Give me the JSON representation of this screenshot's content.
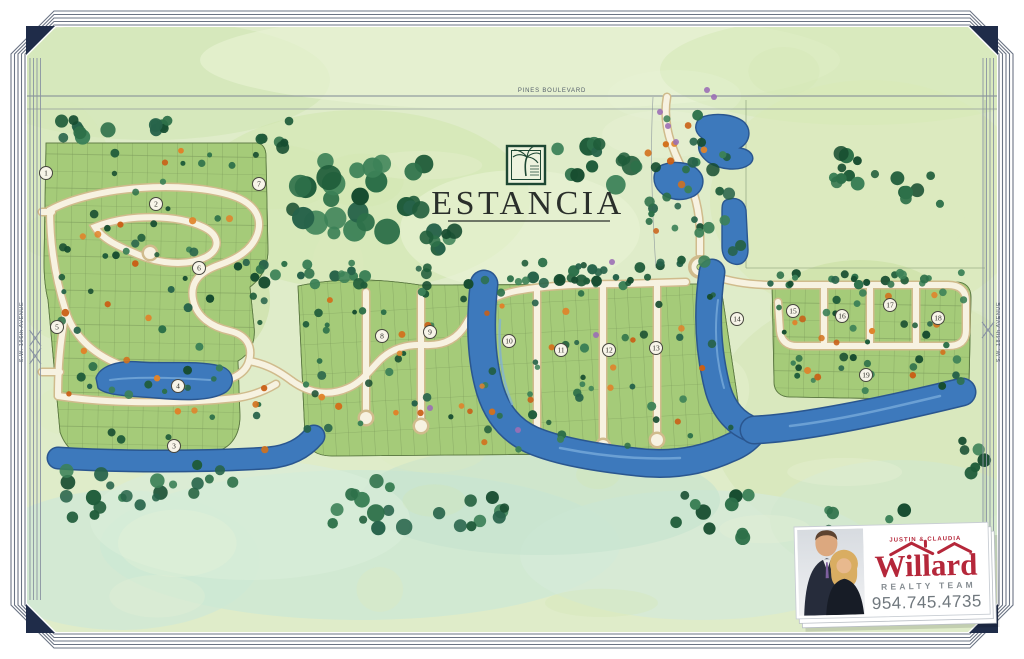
{
  "map": {
    "title": "ESTANCIA",
    "roads": {
      "top": "PINES BOULEVARD",
      "left": "S.W. 196th AVENUE",
      "right": "S.W. 184th AVENUE"
    },
    "sections": [
      {
        "num": "1",
        "x": 46,
        "y": 173
      },
      {
        "num": "2",
        "x": 156,
        "y": 204
      },
      {
        "num": "3",
        "x": 174,
        "y": 446
      },
      {
        "num": "4",
        "x": 178,
        "y": 386
      },
      {
        "num": "5",
        "x": 57,
        "y": 327
      },
      {
        "num": "6",
        "x": 199,
        "y": 268
      },
      {
        "num": "7",
        "x": 259,
        "y": 184
      },
      {
        "num": "8",
        "x": 382,
        "y": 336
      },
      {
        "num": "9",
        "x": 430,
        "y": 332
      },
      {
        "num": "10",
        "x": 509,
        "y": 341
      },
      {
        "num": "11",
        "x": 561,
        "y": 350
      },
      {
        "num": "12",
        "x": 609,
        "y": 350
      },
      {
        "num": "13",
        "x": 656,
        "y": 348
      },
      {
        "num": "14",
        "x": 737,
        "y": 319
      },
      {
        "num": "15",
        "x": 793,
        "y": 311
      },
      {
        "num": "16",
        "x": 842,
        "y": 316
      },
      {
        "num": "17",
        "x": 890,
        "y": 305
      },
      {
        "num": "18",
        "x": 938,
        "y": 318
      },
      {
        "num": "19",
        "x": 866,
        "y": 375
      }
    ],
    "colors": {
      "water": "#3d79bc",
      "water_edge": "#2a568f",
      "water_light": "#7fb0de",
      "canvas": "#dfecc9",
      "block": "#a5cb79",
      "road": "#f7f2e1",
      "road_edge": "#d0bb8c",
      "frame_line": "#6b7484",
      "frame_corner": "#1f2c49",
      "tree_green": "#2d7049",
      "tree_orange": "#d2711d",
      "accent_purple": "#9b6fb5"
    }
  },
  "badge": {
    "names": "JUSTIN & CLAUDIA",
    "brand": "Willard",
    "subtitle": "REALTY TEAM",
    "phone": "954.745.4735",
    "brand_color": "#b5273a"
  }
}
